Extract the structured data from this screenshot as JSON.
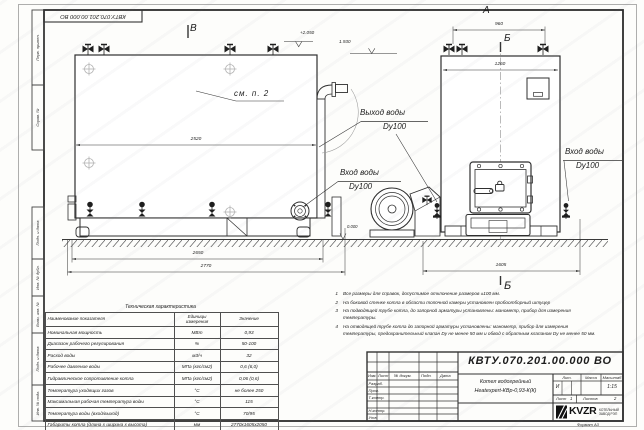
{
  "sheet": {
    "format_note": "Формат   А3",
    "margin_labels": [
      "Перв. примен.",
      "Справ. №",
      "Подп. и дата",
      "Инв. № дубл.",
      "Взам. инв. №",
      "Подп. и дата",
      "Инв. № подл."
    ]
  },
  "views": {
    "label_a": "А",
    "label_b_top": "Б",
    "label_b_bottom": "Б",
    "label_v": "В",
    "see_note": "см. п. 2",
    "water_outlet": {
      "line1": "Выход воды",
      "line2": "Dy100"
    },
    "water_inlet_left": {
      "line1": "Вход воды",
      "line2": "Dy100"
    },
    "water_inlet_right": {
      "line1": "Вход воды",
      "line2": "Dy100"
    },
    "levels": {
      "top": "+2.050",
      "outlet": "1.930",
      "ground": "0.000"
    },
    "dims": {
      "d2520": "2520",
      "d2650": "2650",
      "d2770": "2770",
      "d960": "960",
      "d1260": "1260",
      "d1605": "1605"
    }
  },
  "notes": [
    {
      "n": "1",
      "text": "Все размеры для справок, допустимое отклонение размеров ±100 мм."
    },
    {
      "n": "2",
      "text": "На боковой стенке котла в области топочной камеры установлен пробоотборный штуцер"
    },
    {
      "n": "3",
      "text": "На  подводящей трубе котла, до запорной арматуры установлены: манометр, прибор для измерения температуры."
    },
    {
      "n": "4",
      "text": "На отводящей трубе котла до запорной арматуры установлены: манометр, прибор для измерения температуры, предохранительный клапан Dу не менее 50 мм и обвод с обратным клапаном Dу не менее 50 мм."
    }
  ],
  "spec": {
    "title": "Техническая характеристика",
    "headers": [
      "Наименование показателя",
      "Единицы измерения",
      "Значение"
    ],
    "rows": [
      [
        "Номинальная мощность",
        "МВт",
        "0,93"
      ],
      [
        "Диапазон рабочего регулирования",
        "%",
        "50-100"
      ],
      [
        "Расход воды",
        "м3/ч",
        "32"
      ],
      [
        "Рабочее давление воды",
        "МПа (кгс/см2)",
        "0,6 (6,0)"
      ],
      [
        "Гидравлическое сопротивление котла",
        "МПа (кгс/см2)",
        "0,06 (0,6)"
      ],
      [
        "Температура уходящих газов",
        "°С",
        "не более 250"
      ],
      [
        "Максимальная рабочая температура воды",
        "°С",
        "115"
      ],
      [
        "Температура воды (вход/выход)",
        "°С",
        "70/95"
      ],
      [
        "Габариты котла (длина х ширина х высота)",
        "мм",
        "2770х1605х2050"
      ]
    ]
  },
  "title_block": {
    "doc_number": "КВТУ.070.201.00.000  ВО",
    "name1": "Котел водогрейный",
    "name2": "Heatexpert-КВр-0,93-К(К)",
    "col_izm": "Изм.",
    "col_list": "Лист",
    "col_doc": "№ докум.",
    "col_podp": "Подп.",
    "col_data": "Дата",
    "row_razrab": "Разраб.",
    "row_prov": "Пров.",
    "row_tkontr": "Т.контр.",
    "row_nkontr": "Н.контр.",
    "row_utv": "Утв.",
    "lit_label": "Лит.",
    "mass_label": "Масса",
    "scale_label": "Масштаб",
    "lit_value": "И",
    "scale_value": "1:15",
    "sheet_label": "Лист",
    "sheet_value": "1",
    "sheets_label": "Листов",
    "sheets_value": "2",
    "logo_text": "KVZR",
    "logo_line1": "КОТЕЛЬНЫЙ",
    "logo_line2": "ЗАВОД РЭП"
  }
}
